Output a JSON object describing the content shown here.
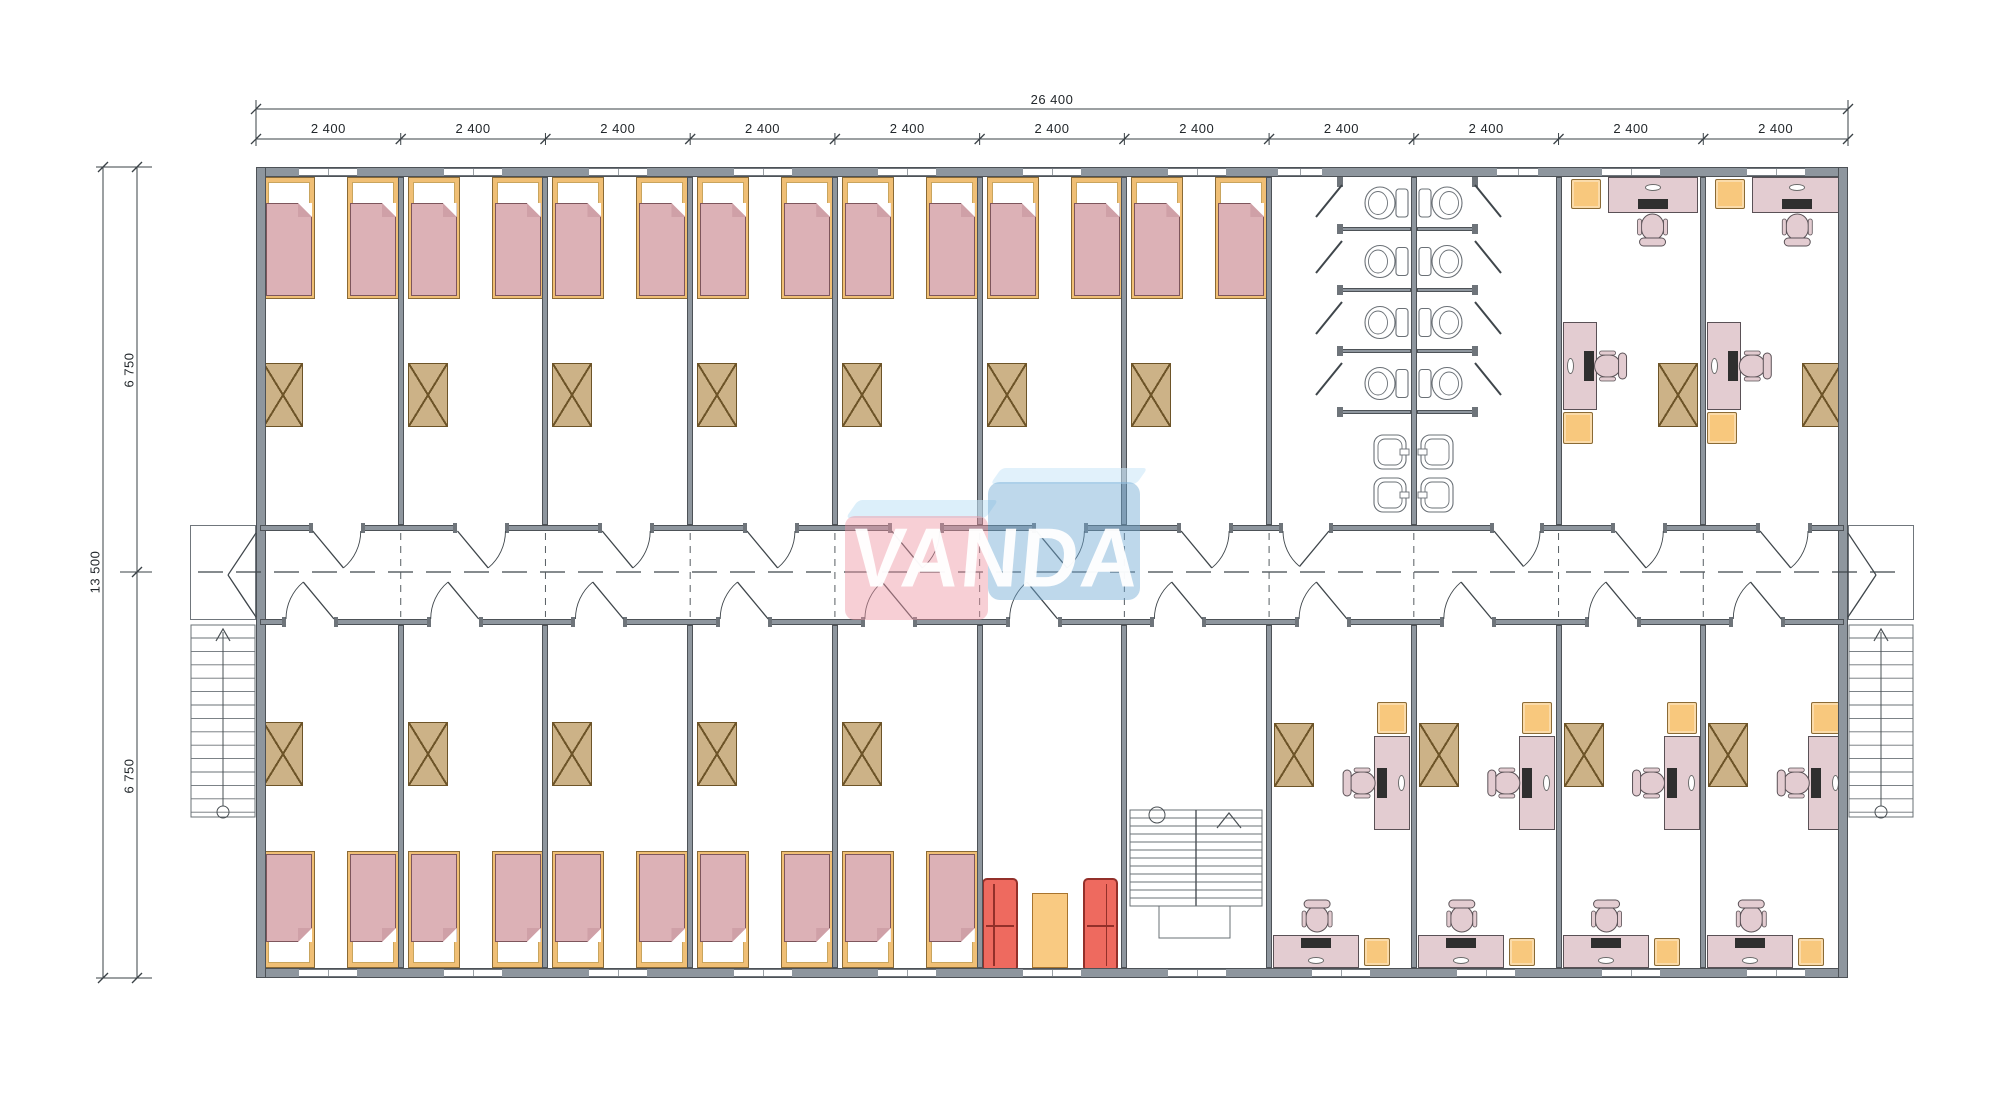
{
  "title": "Modular building floor plan",
  "dimensions": {
    "overall_width": "26 400",
    "module": "2 400",
    "module_count": 11,
    "overall_height": "13 500",
    "half_height": "6 750"
  },
  "watermark": {
    "text": "VANDA",
    "pink": "rgba(238,148,162,0.45)",
    "blue": "rgba(111,168,210,0.45)",
    "bevel": "rgba(196,228,246,0.6)"
  },
  "plan": {
    "top_band": [
      {
        "type": "bedroom"
      },
      {
        "type": "bedroom"
      },
      {
        "type": "bedroom"
      },
      {
        "type": "bedroom"
      },
      {
        "type": "bedroom"
      },
      {
        "type": "bedroom"
      },
      {
        "type": "bedroom"
      },
      {
        "type": "bathroom",
        "modules": 2
      },
      {
        "type": "office"
      },
      {
        "type": "office"
      }
    ],
    "bottom_band": [
      {
        "type": "bedroom"
      },
      {
        "type": "bedroom"
      },
      {
        "type": "bedroom"
      },
      {
        "type": "bedroom"
      },
      {
        "type": "bedroom"
      },
      {
        "type": "lounge"
      },
      {
        "type": "staircase"
      },
      {
        "type": "office"
      },
      {
        "type": "office"
      },
      {
        "type": "office"
      },
      {
        "type": "office"
      }
    ],
    "corridor": "central corridor with doors to every room and exterior stairs at both ends"
  },
  "colors": {
    "wall": "#8e969e",
    "wall_edge": "#4d5257",
    "bed_frame": "#f0bf75",
    "mattress": "#dcb1b6",
    "wardrobe": "#ccb287",
    "desk": "#e3ccd1",
    "desk_edge": "#5a5156",
    "cabinet": "#f8c87d",
    "sofa": "#ee6a5f",
    "table": "#f9ca82",
    "fixture_stroke": "#6a7076",
    "line": "#3a4146",
    "monitor": "#2f2f2f"
  }
}
